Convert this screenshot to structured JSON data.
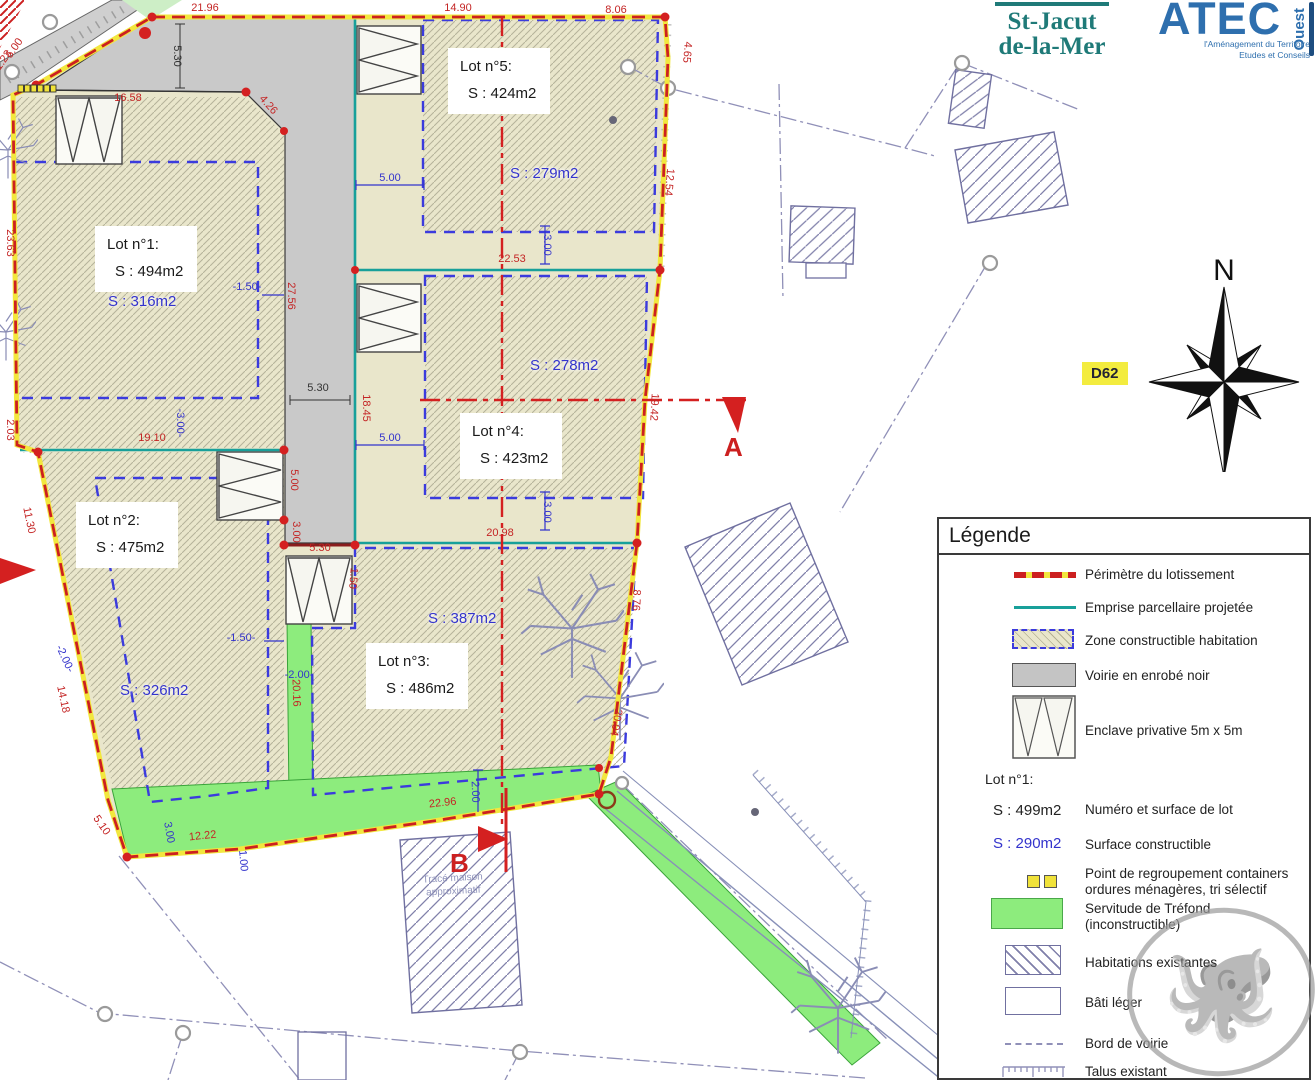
{
  "header": {
    "commune_l1": "St-Jacut",
    "commune_l2": "de-la-Mer",
    "atec_name": "ATEC",
    "atec_region": "Ouest",
    "atec_sub1": "l'Aménagement du Territoire",
    "atec_sub2": "Etudes et Conseils"
  },
  "map": {
    "north": "N",
    "road_ref": "D62",
    "section_a": "A",
    "section_b": "B",
    "house_note_l1": "Tracé maison",
    "house_note_l2": "approximatif"
  },
  "lots": [
    {
      "title": "Lot n°1:",
      "surface": "S : 494m2",
      "constructible": "S : 316m2"
    },
    {
      "title": "Lot n°2:",
      "surface": "S : 475m2",
      "constructible": "S : 326m2"
    },
    {
      "title": "Lot n°3:",
      "surface": "S : 486m2",
      "constructible": "S : 387m2"
    },
    {
      "title": "Lot n°4:",
      "surface": "S : 423m2",
      "constructible": "S : 278m2"
    },
    {
      "title": "Lot n°5:",
      "surface": "S : 424m2",
      "constructible": "S : 279m2"
    }
  ],
  "legend": {
    "title": "Légende",
    "perimetre": "Périmètre du lotissement",
    "emprise": "Emprise parcellaire projetée",
    "zone": "Zone constructible habitation",
    "voirie": "Voirie en enrobé noir",
    "enclave": "Enclave privative 5m x 5m",
    "lot_example_title": "Lot n°1:",
    "lot_example_surface": "S : 499m2",
    "lot_example_surface_label": "Numéro et surface de lot",
    "lot_example_constructible": "S : 290m2",
    "lot_example_constructible_label": "Surface constructible",
    "containers_l1": "Point de regroupement containers",
    "containers_l2": "ordures ménagères, tri sélectif",
    "servitude_l1": "Servitude de Tréfond",
    "servitude_l2": "(inconstructible)",
    "habitations": "Habitations existantes",
    "bati": "Bâti léger",
    "bord": "Bord de voirie",
    "talus": "Talus existant"
  },
  "colors": {
    "r": "#c42525",
    "b": "#3333cc",
    "k": "#333333"
  },
  "dimensions": [
    {
      "text": "21.96",
      "x": 205,
      "y": 11,
      "c": "r",
      "rot": 0
    },
    {
      "text": "14.90",
      "x": 458,
      "y": 11,
      "c": "r",
      "rot": 0
    },
    {
      "text": "8.06",
      "x": 616,
      "y": 13,
      "c": "r",
      "rot": 0
    },
    {
      "text": "16.58",
      "x": 128,
      "y": 101,
      "c": "r",
      "rot": 0
    },
    {
      "text": "4.26",
      "x": 266,
      "y": 107,
      "c": "r",
      "rot": 48
    },
    {
      "text": "4.65",
      "x": 684,
      "y": 52,
      "c": "r",
      "rot": 95
    },
    {
      "text": "12.54",
      "x": 666,
      "y": 182,
      "c": "r",
      "rot": 95
    },
    {
      "text": "22.53",
      "x": 512,
      "y": 262,
      "c": "r",
      "rot": 0
    },
    {
      "text": "19.42",
      "x": 651,
      "y": 407,
      "c": "r",
      "rot": 93
    },
    {
      "text": "18.45",
      "x": 363,
      "y": 408,
      "c": "r",
      "rot": 90
    },
    {
      "text": "27.56",
      "x": 288,
      "y": 296,
      "c": "r",
      "rot": 90
    },
    {
      "text": "20.98",
      "x": 500,
      "y": 536,
      "c": "r",
      "rot": 0
    },
    {
      "text": "19.10",
      "x": 152,
      "y": 441,
      "c": "r",
      "rot": 0
    },
    {
      "text": "23.63",
      "x": 7,
      "y": 243,
      "c": "r",
      "rot": 90
    },
    {
      "text": "2.03",
      "x": 7,
      "y": 430,
      "c": "r",
      "rot": 90
    },
    {
      "text": "11.30",
      "x": 26,
      "y": 521,
      "c": "r",
      "rot": 78
    },
    {
      "text": "14.18",
      "x": 60,
      "y": 700,
      "c": "r",
      "rot": 78
    },
    {
      "text": "5.10",
      "x": 99,
      "y": 827,
      "c": "r",
      "rot": 55
    },
    {
      "text": "12.22",
      "x": 203,
      "y": 839,
      "c": "r",
      "rot": -6
    },
    {
      "text": "22.96",
      "x": 443,
      "y": 806,
      "c": "r",
      "rot": -6
    },
    {
      "text": "20.16",
      "x": 293,
      "y": 693,
      "c": "r",
      "rot": 88
    },
    {
      "text": "8.76",
      "x": 633,
      "y": 600,
      "c": "r",
      "rot": 93
    },
    {
      "text": "20.04",
      "x": 613,
      "y": 722,
      "c": "r",
      "rot": 100
    },
    {
      "text": "5.00",
      "x": 291,
      "y": 480,
      "c": "r",
      "rot": 90
    },
    {
      "text": "3.00",
      "x": 293,
      "y": 532,
      "c": "r",
      "rot": 90
    },
    {
      "text": "5.30",
      "x": 320,
      "y": 551,
      "c": "r",
      "rot": 0
    },
    {
      "text": "1.50",
      "x": 350,
      "y": 578,
      "c": "r",
      "rot": 95
    },
    {
      "text": "5.00",
      "x": 17,
      "y": 50,
      "c": "r",
      "rot": -55
    },
    {
      "text": "1.23",
      "x": 6,
      "y": 62,
      "c": "r",
      "rot": -55
    },
    {
      "text": "5.30",
      "x": 174,
      "y": 56,
      "c": "k",
      "rot": 90
    },
    {
      "text": "5.30",
      "x": 318,
      "y": 391,
      "c": "k",
      "rot": 0
    },
    {
      "text": "5.00",
      "x": 390,
      "y": 181,
      "c": "b",
      "rot": 0
    },
    {
      "text": "3.00",
      "x": 544,
      "y": 245,
      "c": "b",
      "rot": 90
    },
    {
      "text": "5.00",
      "x": 390,
      "y": 441,
      "c": "b",
      "rot": 0
    },
    {
      "text": "3.00",
      "x": 544,
      "y": 512,
      "c": "b",
      "rot": 90
    },
    {
      "text": "-1.50-",
      "x": 247,
      "y": 290,
      "c": "b",
      "rot": 0
    },
    {
      "text": "-3.00-",
      "x": 177,
      "y": 423,
      "c": "b",
      "rot": 90
    },
    {
      "text": "-1.50-",
      "x": 241,
      "y": 641,
      "c": "b",
      "rot": 0
    },
    {
      "text": "-2.00-",
      "x": 62,
      "y": 660,
      "c": "b",
      "rot": 65
    },
    {
      "text": "-2.00-",
      "x": 299,
      "y": 678,
      "c": "b",
      "rot": 0
    },
    {
      "text": "3.00",
      "x": 166,
      "y": 833,
      "c": "b",
      "rot": 80
    },
    {
      "text": "1.00",
      "x": 240,
      "y": 861,
      "c": "b",
      "rot": 85
    },
    {
      "text": "2.00",
      "x": 472,
      "y": 792,
      "c": "b",
      "rot": 88
    }
  ]
}
